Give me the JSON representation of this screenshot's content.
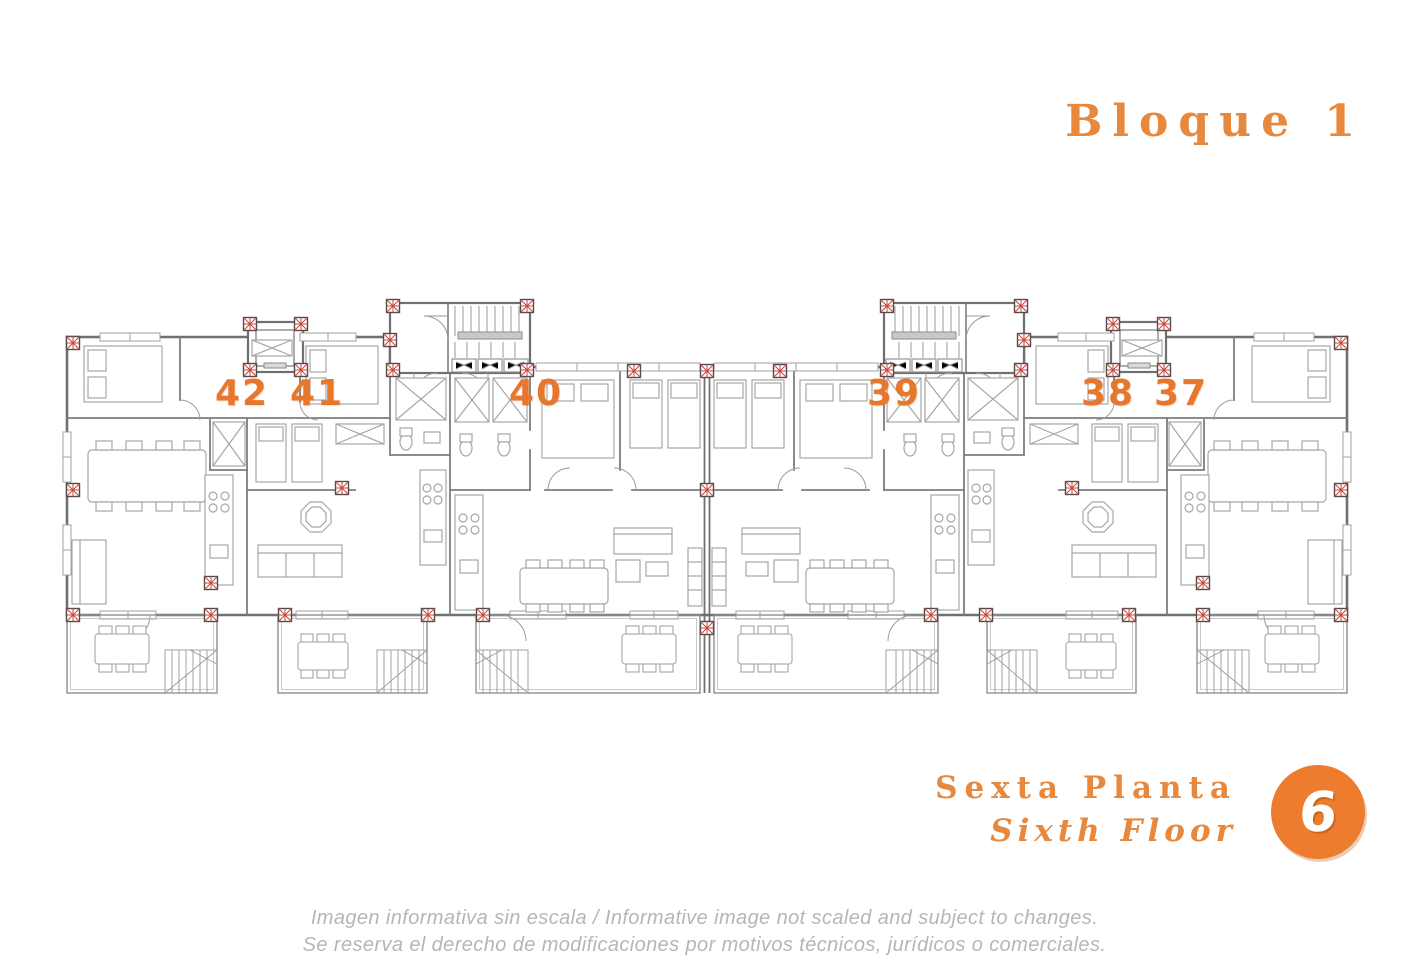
{
  "header": {
    "title": "Bloque 1"
  },
  "plan": {
    "units": [
      {
        "number": "42"
      },
      {
        "number": "41"
      },
      {
        "number": "40"
      },
      {
        "number": "39"
      },
      {
        "number": "38"
      },
      {
        "number": "37"
      }
    ],
    "colors": {
      "unit_number": "#E8772E",
      "walls": "#707070",
      "furniture": "#a6a6a6",
      "column_marker_red": "#C8453A"
    }
  },
  "floor_label": {
    "line_es": "Sexta Planta",
    "line_en": "Sixth Floor",
    "badge": "6"
  },
  "colors": {
    "accent_orange": "#E8883C",
    "badge_orange": "#ED7C2E",
    "footer_gray": "#b6b6b6"
  },
  "footer": {
    "line1": "Imagen informativa sin escala /  Informative image not scaled and subject to changes.",
    "line2": "Se reserva el derecho de modificaciones por motivos técnicos, jurídicos o comerciales."
  }
}
